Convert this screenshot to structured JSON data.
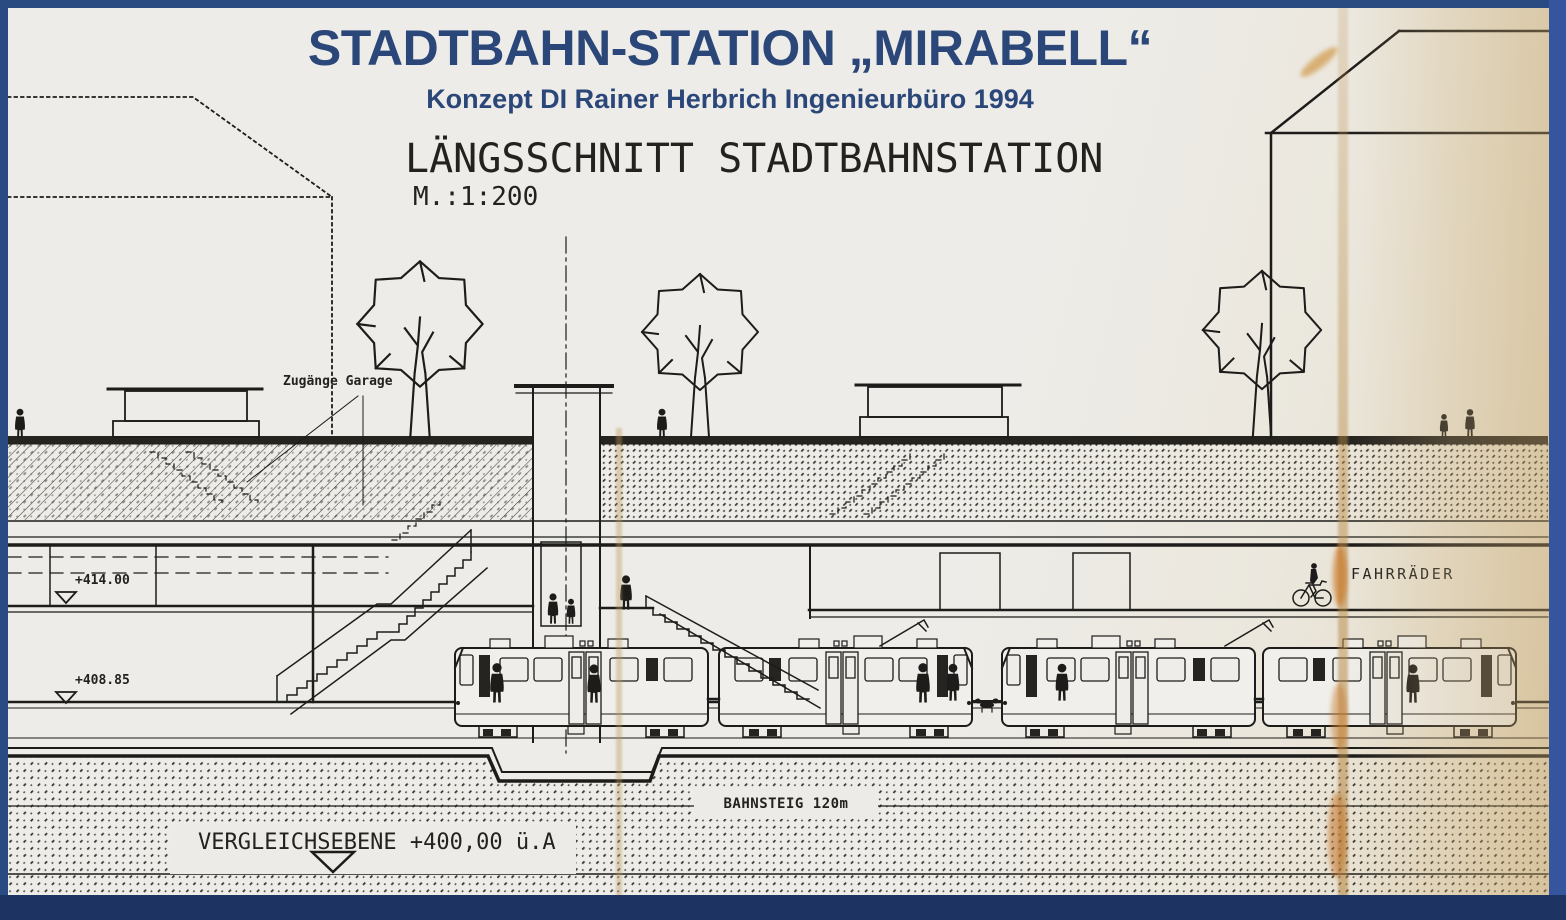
{
  "titleblock": {
    "title": "STADTBAHN-STATION „MIRABELL“",
    "subtitle": "Konzept DI Rainer Herbrich Ingenieurbüro 1994",
    "drawing_title": "LÄNGSSCHNITT STADTBAHNSTATION",
    "scale_label": "M.:1:200"
  },
  "annotations": {
    "garage_access": "Zugänge Garage",
    "level_upper": "+414.00",
    "level_lower": "+408.85",
    "bicycles": "FAHRRÄDER",
    "platform_length": "BAHNSTEIG 120m",
    "datum_plane": "VERGLEICHSEBENE +400,00 ü.A"
  },
  "colors": {
    "frame_navy": "#2a4a82",
    "frame_bottom": "#1d3463",
    "title_blue": "#2b4779",
    "paper": "#ecebe7",
    "ink": "#1d1c1a",
    "stain_tan": "#c9a368"
  }
}
